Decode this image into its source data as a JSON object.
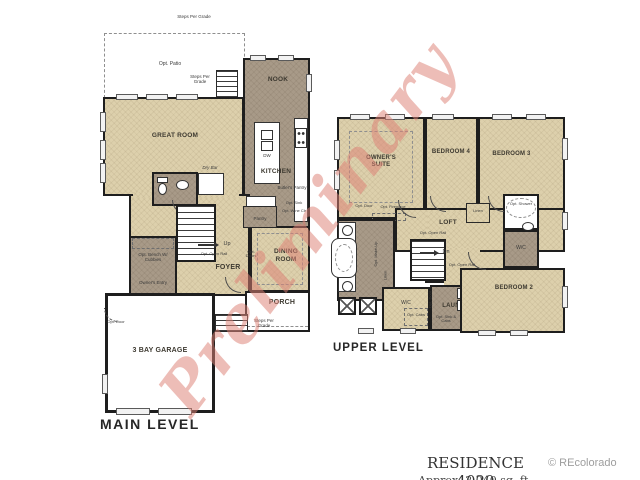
{
  "watermark": {
    "text": "Preliminary",
    "color": "#dc8074"
  },
  "colors": {
    "room_light": "#ddd0ac",
    "room_dark": "#a89a88",
    "wall": "#1e1e1e",
    "copyright_gray": "#9e9e9e"
  },
  "footer": {
    "residence": "RESIDENCE 4020",
    "caption_cropped": "Approx. 2,040 sq. ft.",
    "copyright": "© REcolorado"
  },
  "main_level": {
    "title": "MAIN LEVEL",
    "rooms": {
      "great_room": "GREAT ROOM",
      "nook": "NOOK",
      "kitchen": "KITCHEN",
      "dining_room": "DINING ROOM",
      "foyer": "FOYER",
      "porch": "PORCH",
      "garage": "3 BAY GARAGE",
      "pantry": "Pantry"
    },
    "annotations": {
      "steps_top": "Steps Per Grade",
      "opt_patio": "Opt. Patio",
      "steps_patio": "Steps Per Grade",
      "dry_bar": "Dry Bar",
      "dw": "DW",
      "butlers_pantry": "Butler's Pantry",
      "opt_sink": "Opt. Sink",
      "opt_wine": "Opt. Wine Clr",
      "up": "Up",
      "opt_open_rail": "Opt. Open Rail",
      "opt_doors": "Opt. Doors",
      "opt_bench": "Opt. Bench W/ Cubbies",
      "owners_entry": "Owner's Entry",
      "steps_entry": "Steps Per Grade",
      "steps_porch": "Steps Per Grade",
      "opt_door_garage": "Opt. Door"
    }
  },
  "upper_level": {
    "title": "UPPER LEVEL",
    "rooms": {
      "owners_suite": "OWNER'S SUITE",
      "bedroom4": "BEDROOM 4",
      "bedroom3": "BEDROOM 3",
      "bedroom2": "BEDROOM 2",
      "loft": "LOFT",
      "laundry": "LAUN",
      "wc_owners": "W/C",
      "wc_bath2": "W/C"
    },
    "annotations": {
      "opt_door": "Opt. Door",
      "opt_fireplace": "Opt. Fireplace",
      "linen_hall": "Linen",
      "opt_shower": "Opt. Shower",
      "opt_open_rail_1": "Opt. Open Rail",
      "opt_open_rail_2": "Opt. Open Rail",
      "dn": "Dn",
      "opt_makeup": "Opt. Make-Up",
      "linen_bath": "Linen",
      "opt_cabs": "Opt. Cabs",
      "washer": "W",
      "dryer": "D",
      "opt_sink_cabs": "Opt. Sink & Cabs",
      "opt_door_laundry": "Opt. Door"
    }
  }
}
